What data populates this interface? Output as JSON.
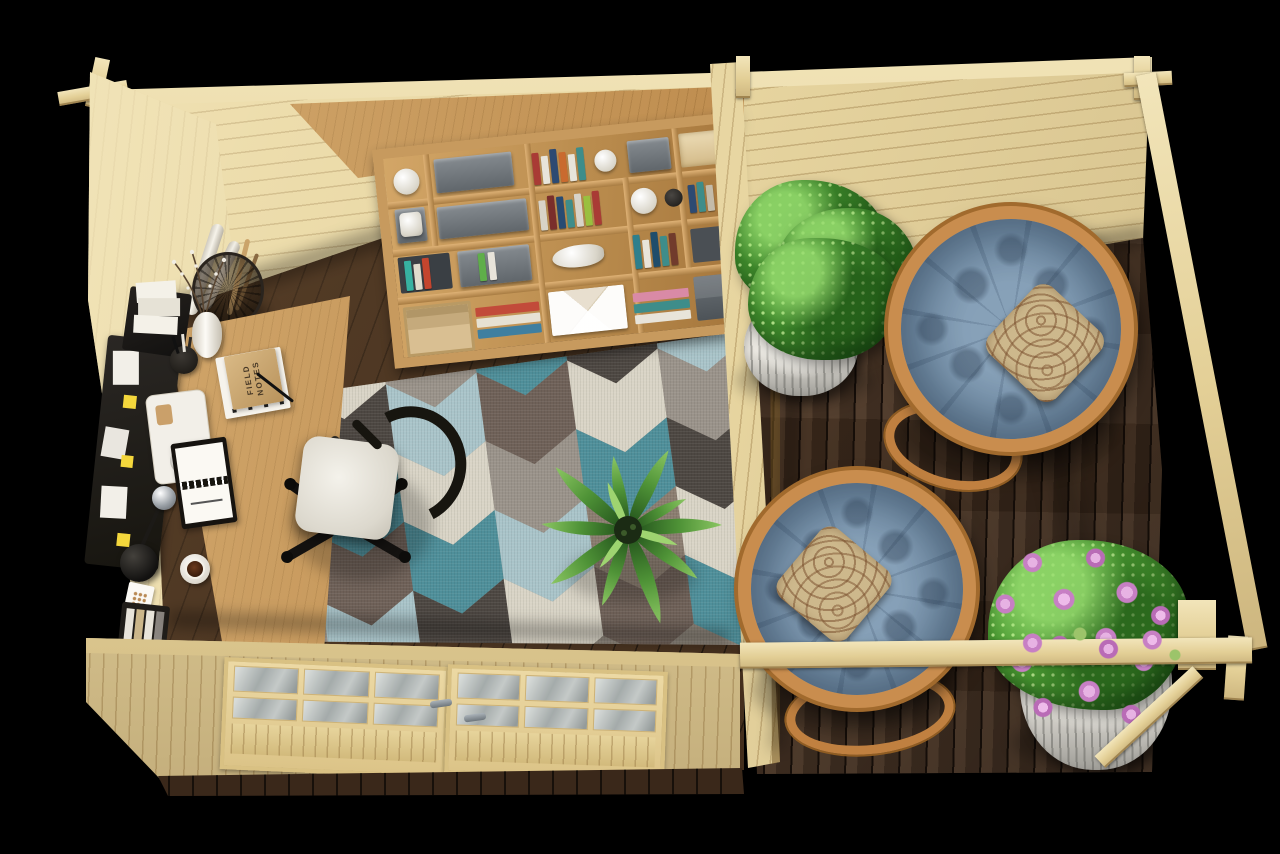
{
  "scene": {
    "type": "3d-render-top-view",
    "description": "Top-down view of a pine garden office cabin with a furnished home-office room on the left and an open decked terrace with papasan chairs on the right",
    "canvas": {
      "width": 1280,
      "height": 854
    }
  },
  "labels": {
    "notebook_line1": "FIELD",
    "notebook_line2": "NOTES"
  },
  "palette": {
    "bg": "#000000",
    "pine": "#e7d5a0",
    "pine-light": "#f2e5ba",
    "pine-dark": "#cdb67f",
    "pine-edge": "#b89f6a",
    "oak": "#c08f51",
    "oak-light": "#d8ac6c",
    "oak-dark": "#9a7038",
    "floor-dark": "#46311f",
    "deck-brown": "#4a3322",
    "rug-teal": "#4f8f9a",
    "rug-blue": "#a9c4c9",
    "rug-cream": "#d9d4c6",
    "rug-taupe": "#8b7d70",
    "rug-gray": "#9a938a",
    "rug-dark": "#4d4742",
    "rug-brown": "#6f6158",
    "cushion-blue": "#7590a8",
    "rattan": "#c98d4e",
    "pillow-beige": "#cdb88c",
    "pillow-brown": "#7d5331",
    "leaf-green": "#3f8a2c",
    "flower-pink": "#c77fc4",
    "white-soft": "#eceae3",
    "chair-black": "#17150f"
  },
  "office": {
    "objects": [
      "pine back wall",
      "pine left wall",
      "glazed double doors",
      "oak shelving unit with books and boxes",
      "oak corner desk",
      "white office chair with black base",
      "geometric chevron rug",
      "wire basket with paper rolls",
      "potted palm",
      "desk lamp",
      "coffee cup on saucer",
      "kraft notebook",
      "spiral notepad",
      "dark pegboard with sticky notes",
      "document tray",
      "pen cup"
    ]
  },
  "terrace": {
    "objects": [
      "dark brown decking",
      "papasan chair with blue tufted cushion and paisley pillow",
      "second papasan chair with blue tufted cushion and paisley pillow",
      "green shrub in white wicker planter",
      "pink flowering plant in white wicker planter",
      "pergola posts and rails"
    ]
  },
  "rug_pattern": {
    "cols": 6,
    "rows": 5,
    "cell": {
      "w": 80,
      "h": 62
    },
    "point_depth": 26,
    "colors": [
      [
        "#8b7d70",
        "#4f8f9a",
        "#a9c4c9",
        "#4d4742",
        "#9a938a"
      ],
      [
        "#d9d4c6",
        "#4d4742",
        "#4f8f9a",
        "#6f6158",
        "#a9c4c9"
      ],
      [
        "#9a938a",
        "#a9c4c9",
        "#d9d4c6",
        "#4f8f9a",
        "#4d4742"
      ],
      [
        "#4f8f9a",
        "#6f6158",
        "#9a938a",
        "#a9c4c9",
        "#d9d4c6"
      ],
      [
        "#4d4742",
        "#d9d4c6",
        "#4f8f9a",
        "#8b7d70",
        "#6f6158"
      ],
      [
        "#a9c4c9",
        "#9a938a",
        "#4d4742",
        "#d9d4c6",
        "#4f8f9a"
      ]
    ]
  }
}
